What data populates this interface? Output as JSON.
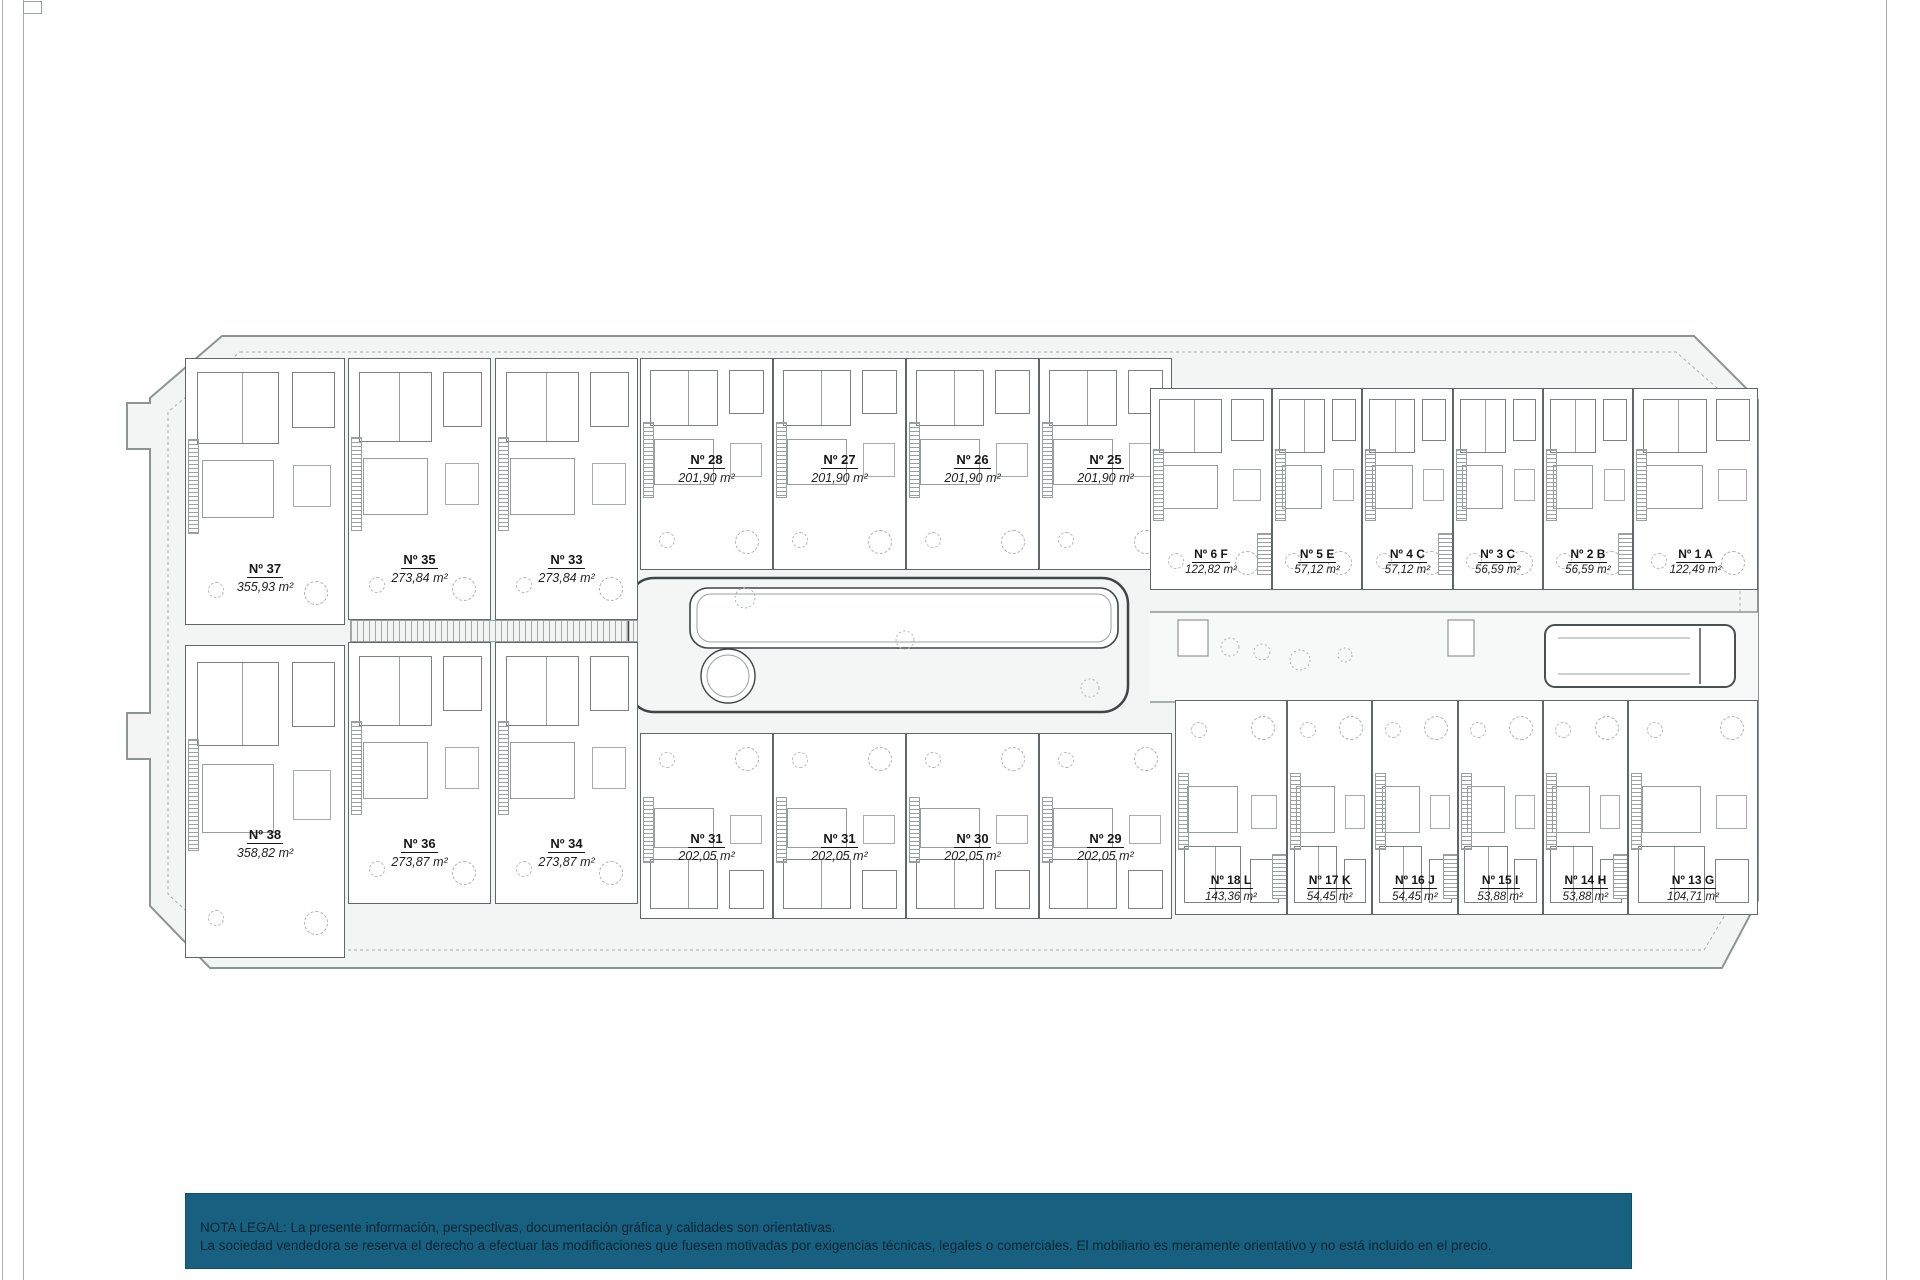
{
  "page": {
    "background": "#ffffff",
    "artifact_line_color": "#a9adb0"
  },
  "plan": {
    "site_fill": "#f3f5f4",
    "boundary_color": "#8d9494",
    "wall_color": "#60666a",
    "groups": {
      "left_plots": {
        "label": "detached villas",
        "items": [
          {
            "num": "Nº 37",
            "area": "355,93 m²"
          },
          {
            "num": "Nº 38",
            "area": "358,82 m²"
          }
        ]
      },
      "villas": {
        "label": "semi-detached villas",
        "items": [
          {
            "num": "Nº 35",
            "area": "273,84 m²"
          },
          {
            "num": "Nº 33",
            "area": "273,84 m²"
          },
          {
            "num": "Nº 36",
            "area": "273,87 m²"
          },
          {
            "num": "Nº 34",
            "area": "273,87 m²"
          }
        ]
      },
      "row_top": {
        "label": "townhouses north row",
        "items": [
          {
            "num": "Nº 28",
            "area": "201,90 m²"
          },
          {
            "num": "Nº 27",
            "area": "201,90 m²"
          },
          {
            "num": "Nº 26",
            "area": "201,90 m²"
          },
          {
            "num": "Nº 25",
            "area": "201,90 m²"
          }
        ]
      },
      "row_bottom": {
        "label": "townhouses south row",
        "items": [
          {
            "num": "Nº 31",
            "area": "202,05 m²"
          },
          {
            "num": "Nº 31",
            "area": "202,05 m²"
          },
          {
            "num": "Nº 30",
            "area": "202,05 m²"
          },
          {
            "num": "Nº 29",
            "area": "202,05 m²"
          }
        ]
      },
      "apartments_top": {
        "label": "apartments north block",
        "items": [
          {
            "num": "Nº 6 F",
            "area": "122,82 m²"
          },
          {
            "num": "Nº 5 E",
            "area": "57,12 m²"
          },
          {
            "num": "Nº 4 C",
            "area": "57,12 m²"
          },
          {
            "num": "Nº 3 C",
            "area": "56,59 m²"
          },
          {
            "num": "Nº 2 B",
            "area": "56,59 m²"
          },
          {
            "num": "Nº 1 A",
            "area": "122,49 m²"
          }
        ]
      },
      "apartments_bottom": {
        "label": "apartments south block",
        "items": [
          {
            "num": "Nº 18 L",
            "area": "143,36 m²"
          },
          {
            "num": "Nº 17 K",
            "area": "54,45 m²"
          },
          {
            "num": "Nº 16 J",
            "area": "54,45 m²"
          },
          {
            "num": "Nº 15 I",
            "area": "53,88 m²"
          },
          {
            "num": "Nº 14 H",
            "area": "53,88 m²"
          },
          {
            "num": "Nº 13 G",
            "area": "104,71 m²"
          }
        ]
      }
    }
  },
  "legal": {
    "bar_color": "#186080",
    "text_color": "#0b2533",
    "line1": "NOTA LEGAL: La presente información, perspectivas, documentación gráfica y calidades son orientativas.",
    "line2": "La sociedad vendedora se reserva el derecho a efectuar las modificaciones que fuesen motivadas por exigencias técnicas, legales o comerciales. El mobiliario es meramente orientativo y no está incluido en el precio."
  }
}
